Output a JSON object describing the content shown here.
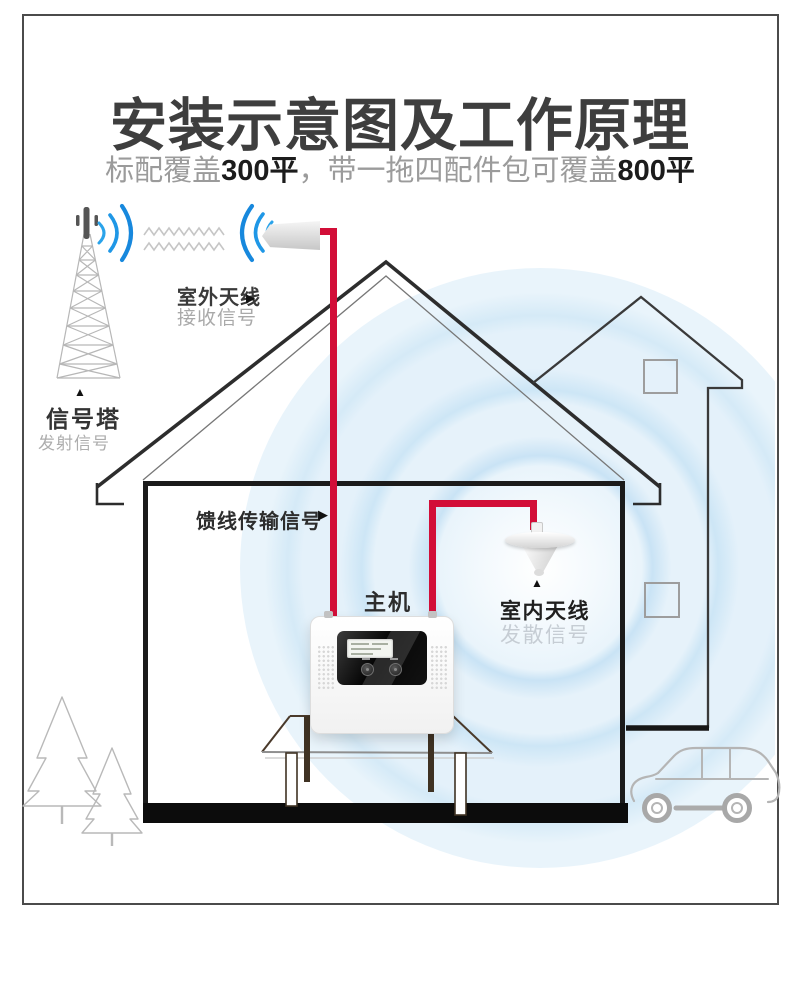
{
  "page": {
    "title": "安装示意图及工作原理",
    "subtitle": {
      "part1": "标配覆盖",
      "em1": "300平",
      "part2": "，带一拖四配件包可覆盖",
      "em2": "800平"
    }
  },
  "labels": {
    "tower_name": "信号塔",
    "tower_caption": "发射信号",
    "outdoor_name": "室外天线",
    "outdoor_caption": "接收信号",
    "feeder": "馈线传输信号",
    "host": "主机",
    "indoor_name": "室内天线",
    "indoor_caption": "发散信号"
  },
  "icons": {
    "arrow_right": "▶",
    "arrow_up": "▲"
  },
  "colors": {
    "cable_red": "#d20e38",
    "signal_blue": "#1f97e6",
    "ripple_blue": "#cfe7f6",
    "line_dark": "#2d2d2d",
    "sketch_gray": "#b7b7b7",
    "floor_black": "#0c0c0c"
  }
}
